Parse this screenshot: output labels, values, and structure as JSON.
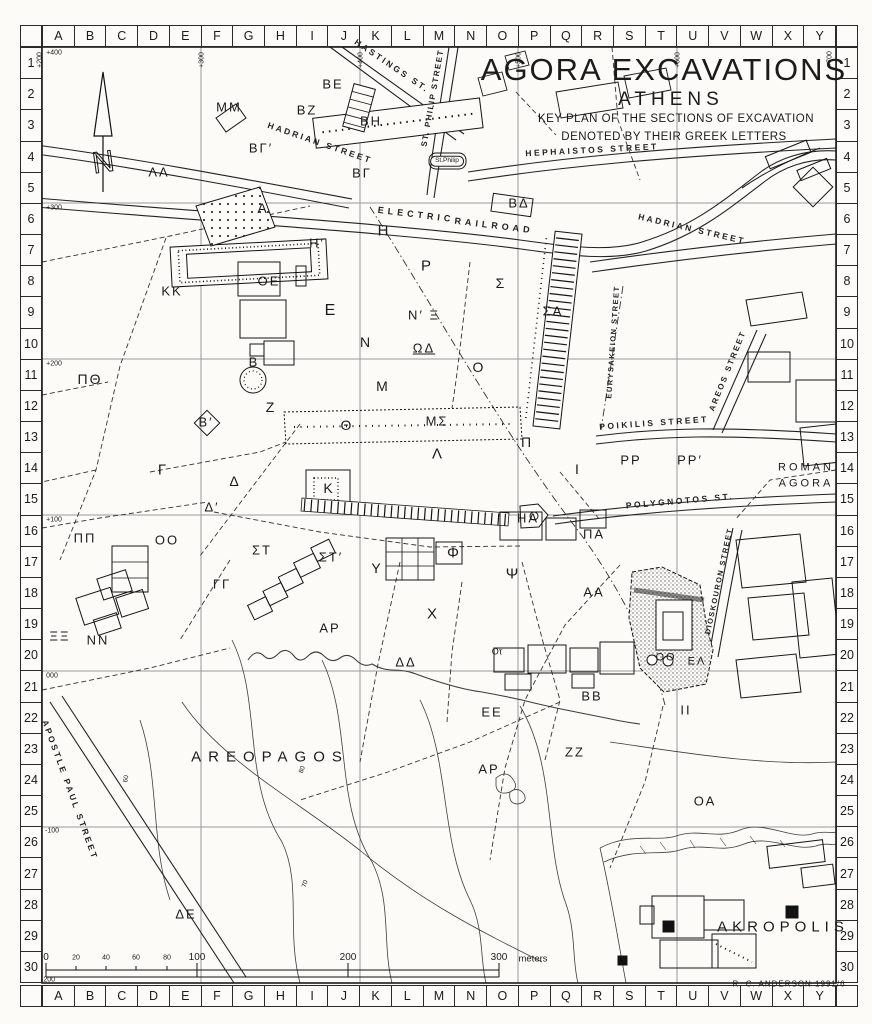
{
  "title": {
    "main": "AGORA EXCAVATIONS",
    "city": "ATHENS",
    "sub1": "KEY PLAN OF THE SECTIONS OF EXCAVATION",
    "sub2": "DENOTED BY THEIR GREEK LETTERS"
  },
  "credit": "R. C. ANDERSON  1991/6",
  "north_arrow": "N",
  "colors": {
    "ink": "#1b1b1b",
    "grid_line": "#9a9a9a",
    "paper": "#fcfbf7"
  },
  "grid": {
    "columns": [
      "A",
      "B",
      "C",
      "D",
      "E",
      "F",
      "G",
      "H",
      "I",
      "J",
      "K",
      "L",
      "M",
      "N",
      "O",
      "P",
      "Q",
      "R",
      "S",
      "T",
      "U",
      "V",
      "W",
      "X",
      "Y"
    ],
    "rows": [
      "1",
      "2",
      "3",
      "4",
      "5",
      "6",
      "7",
      "8",
      "9",
      "10",
      "11",
      "12",
      "13",
      "14",
      "15",
      "16",
      "17",
      "18",
      "19",
      "20",
      "21",
      "22",
      "23",
      "24",
      "25",
      "26",
      "27",
      "28",
      "29",
      "30"
    ]
  },
  "coordinates": {
    "northings": [
      {
        "label": "+400",
        "x": 54,
        "y": 53
      },
      {
        "label": "+300",
        "x": 54,
        "y": 208
      },
      {
        "label": "+200",
        "x": 54,
        "y": 364
      },
      {
        "label": "+100",
        "x": 54,
        "y": 520
      },
      {
        "label": "000",
        "x": 52,
        "y": 676
      },
      {
        "label": "-100",
        "x": 52,
        "y": 831
      },
      {
        "label": "-200",
        "x": 48,
        "y": 980
      }
    ],
    "eastings": [
      {
        "label": "+200",
        "x": 40,
        "y": 60
      },
      {
        "label": "+300",
        "x": 202,
        "y": 60
      },
      {
        "label": "+400",
        "x": 361,
        "y": 60
      },
      {
        "label": "+500",
        "x": 519,
        "y": 60
      },
      {
        "label": "+600",
        "x": 678,
        "y": 60
      },
      {
        "label": "+700",
        "x": 830,
        "y": 59
      }
    ]
  },
  "streets": [
    {
      "label": "HASTINGS  ST.",
      "x": 392,
      "y": 66,
      "rot": 34
    },
    {
      "label": "ST. PHILIP  STREET",
      "x": 433,
      "y": 98,
      "rot": -80,
      "size": 8,
      "ls": 1.5
    },
    {
      "label": "HADRIAN  STREET",
      "x": 320,
      "y": 143,
      "rot": 19
    },
    {
      "label": "HEPHAISTOS   STREET",
      "x": 592,
      "y": 150,
      "rot": -3
    },
    {
      "label": "ELECTRIC",
      "x": 416,
      "y": 215,
      "rot": 7,
      "size": 9,
      "ls": 4
    },
    {
      "label": "RAILROAD",
      "x": 494,
      "y": 226,
      "rot": 7,
      "size": 9,
      "ls": 4
    },
    {
      "label": "HADRIAN  STREET",
      "x": 692,
      "y": 229,
      "rot": 13
    },
    {
      "label": "EURYSAKEION  STREET",
      "x": 613,
      "y": 342,
      "rot": -86,
      "size": 7.5,
      "ls": 1.5
    },
    {
      "label": "AREOS  STREET",
      "x": 728,
      "y": 371,
      "rot": -68,
      "size": 8,
      "ls": 2
    },
    {
      "label": "POIKILIS  STREET",
      "x": 654,
      "y": 423,
      "rot": -4
    },
    {
      "label": "POLYGNOTOS  ST.",
      "x": 680,
      "y": 501,
      "rot": -5
    },
    {
      "label": "DIOSKOURON  STREET",
      "x": 719,
      "y": 581,
      "rot": -78,
      "size": 7.5,
      "ls": 1.5
    },
    {
      "label": "APOSTLE  PAUL  STREET",
      "x": 70,
      "y": 790,
      "rot": 70
    }
  ],
  "sections": [
    {
      "label": "ΜΜ",
      "x": 229,
      "y": 107
    },
    {
      "label": "ΒΕ",
      "x": 333,
      "y": 84
    },
    {
      "label": "ΒΖ",
      "x": 307,
      "y": 110
    },
    {
      "label": "ΒΗ",
      "x": 371,
      "y": 121
    },
    {
      "label": "ΒΓ′",
      "x": 261,
      "y": 148
    },
    {
      "label": "ΒΓ",
      "x": 362,
      "y": 173
    },
    {
      "label": "ΛΛ",
      "x": 159,
      "y": 172
    },
    {
      "label": "ΒΔ",
      "x": 519,
      "y": 203
    },
    {
      "label": "Α",
      "x": 263,
      "y": 208,
      "size": 14
    },
    {
      "label": "Η′",
      "x": 317,
      "y": 243
    },
    {
      "label": "Η",
      "x": 384,
      "y": 231,
      "size": 15
    },
    {
      "label": "Ρ",
      "x": 427,
      "y": 266,
      "size": 15
    },
    {
      "label": "ΚΚ",
      "x": 172,
      "y": 291
    },
    {
      "label": "ΟΕ",
      "x": 269,
      "y": 281
    },
    {
      "label": "Ε",
      "x": 331,
      "y": 311,
      "size": 16
    },
    {
      "label": "Σ",
      "x": 501,
      "y": 283,
      "size": 14
    },
    {
      "label": "ΣΑ",
      "x": 553,
      "y": 311
    },
    {
      "label": "Ν′ Ξ",
      "x": 424,
      "y": 315
    },
    {
      "label": "Ν",
      "x": 366,
      "y": 342,
      "size": 14
    },
    {
      "label": "ΩΔ",
      "x": 424,
      "y": 348,
      "u": true
    },
    {
      "label": "Ο",
      "x": 479,
      "y": 367,
      "size": 14
    },
    {
      "label": "Μ",
      "x": 383,
      "y": 386,
      "size": 14
    },
    {
      "label": "Β",
      "x": 254,
      "y": 362
    },
    {
      "label": "Ζ",
      "x": 271,
      "y": 407,
      "size": 14
    },
    {
      "label": "Θ",
      "x": 347,
      "y": 425,
      "size": 14
    },
    {
      "label": "ΜΣ",
      "x": 437,
      "y": 421
    },
    {
      "label": "Λ",
      "x": 438,
      "y": 454,
      "size": 15
    },
    {
      "label": "Π",
      "x": 527,
      "y": 442,
      "size": 14
    },
    {
      "label": "ΠΘ",
      "x": 90,
      "y": 379,
      "size": 14
    },
    {
      "label": "Β′",
      "x": 206,
      "y": 422
    },
    {
      "label": "Γ",
      "x": 163,
      "y": 470,
      "size": 15
    },
    {
      "label": "Δ",
      "x": 235,
      "y": 481,
      "size": 14
    },
    {
      "label": "Κ",
      "x": 329,
      "y": 488,
      "size": 14
    },
    {
      "label": "Δ′",
      "x": 212,
      "y": 507
    },
    {
      "label": "Ι",
      "x": 578,
      "y": 469,
      "size": 14
    },
    {
      "label": "ΡΡ",
      "x": 631,
      "y": 460
    },
    {
      "label": "ΡΡ′",
      "x": 690,
      "y": 460
    },
    {
      "label": "ΠΠ",
      "x": 85,
      "y": 538
    },
    {
      "label": "ΟΟ",
      "x": 167,
      "y": 540
    },
    {
      "label": "ΣΤ",
      "x": 262,
      "y": 550
    },
    {
      "label": "ΣΤ′",
      "x": 331,
      "y": 557
    },
    {
      "label": "ΗΑ",
      "x": 528,
      "y": 518
    },
    {
      "label": "ΠΑ",
      "x": 594,
      "y": 534
    },
    {
      "label": "ΓΓ",
      "x": 222,
      "y": 584
    },
    {
      "label": "Υ",
      "x": 377,
      "y": 568,
      "size": 14
    },
    {
      "label": "Φ",
      "x": 454,
      "y": 553,
      "size": 15
    },
    {
      "label": "Ψ",
      "x": 513,
      "y": 574,
      "size": 15
    },
    {
      "label": "ΞΞ",
      "x": 60,
      "y": 636
    },
    {
      "label": "ΝΝ",
      "x": 98,
      "y": 640
    },
    {
      "label": "ΑΡ",
      "x": 330,
      "y": 628
    },
    {
      "label": "Χ",
      "x": 433,
      "y": 614,
      "size": 15
    },
    {
      "label": "ΑΑ",
      "x": 594,
      "y": 592
    },
    {
      "label": "ΔΔ",
      "x": 406,
      "y": 662
    },
    {
      "label": "Οτ",
      "x": 497,
      "y": 652,
      "size": 9,
      "ls": 0
    },
    {
      "label": "ΒΒ",
      "x": 592,
      "y": 696
    },
    {
      "label": "ΕΕ",
      "x": 492,
      "y": 712
    },
    {
      "label": "ΖΖ",
      "x": 575,
      "y": 752
    },
    {
      "label": "ΙΙ",
      "x": 686,
      "y": 710
    },
    {
      "label": "ΟΟ",
      "x": 666,
      "y": 658,
      "size": 11
    },
    {
      "label": "ΕΛ",
      "x": 697,
      "y": 662,
      "size": 11
    },
    {
      "label": "ΟΑ",
      "x": 705,
      "y": 801
    },
    {
      "label": "ΑΡ",
      "x": 489,
      "y": 769
    },
    {
      "label": "ΔΕ",
      "x": 186,
      "y": 914
    }
  ],
  "regions": [
    {
      "label": "AREOPAGOS",
      "x": 270,
      "y": 757,
      "size": 15,
      "ls": 7
    },
    {
      "label": "ROMAN",
      "x": 806,
      "y": 468,
      "size": 11,
      "ls": 3
    },
    {
      "label": "AGORA",
      "x": 806,
      "y": 484,
      "size": 11,
      "ls": 3
    },
    {
      "label": "AKROPOLIS",
      "x": 783,
      "y": 927,
      "size": 15,
      "ls": 5
    }
  ],
  "landmarks": [
    {
      "label": "St.Philip",
      "x": 447,
      "y": 161,
      "size": 6.5,
      "ls": 0,
      "box": true
    }
  ],
  "contour_labels": [
    {
      "label": "60",
      "x": 127,
      "y": 779,
      "rot": -80
    },
    {
      "label": "80",
      "x": 303,
      "y": 770,
      "rot": -70
    },
    {
      "label": "70",
      "x": 306,
      "y": 884,
      "rot": -75
    }
  ],
  "scalebar": {
    "ticks": [
      {
        "label": "0",
        "x": 46,
        "size": 10
      },
      {
        "label": "20",
        "x": 76,
        "size": 7
      },
      {
        "label": "40",
        "x": 106,
        "size": 7
      },
      {
        "label": "60",
        "x": 136,
        "size": 7
      },
      {
        "label": "80",
        "x": 167,
        "size": 7
      },
      {
        "label": "100",
        "x": 197,
        "size": 10
      },
      {
        "label": "200",
        "x": 348,
        "size": 10
      },
      {
        "label": "300",
        "x": 499,
        "size": 10
      }
    ],
    "unit": "meters"
  }
}
